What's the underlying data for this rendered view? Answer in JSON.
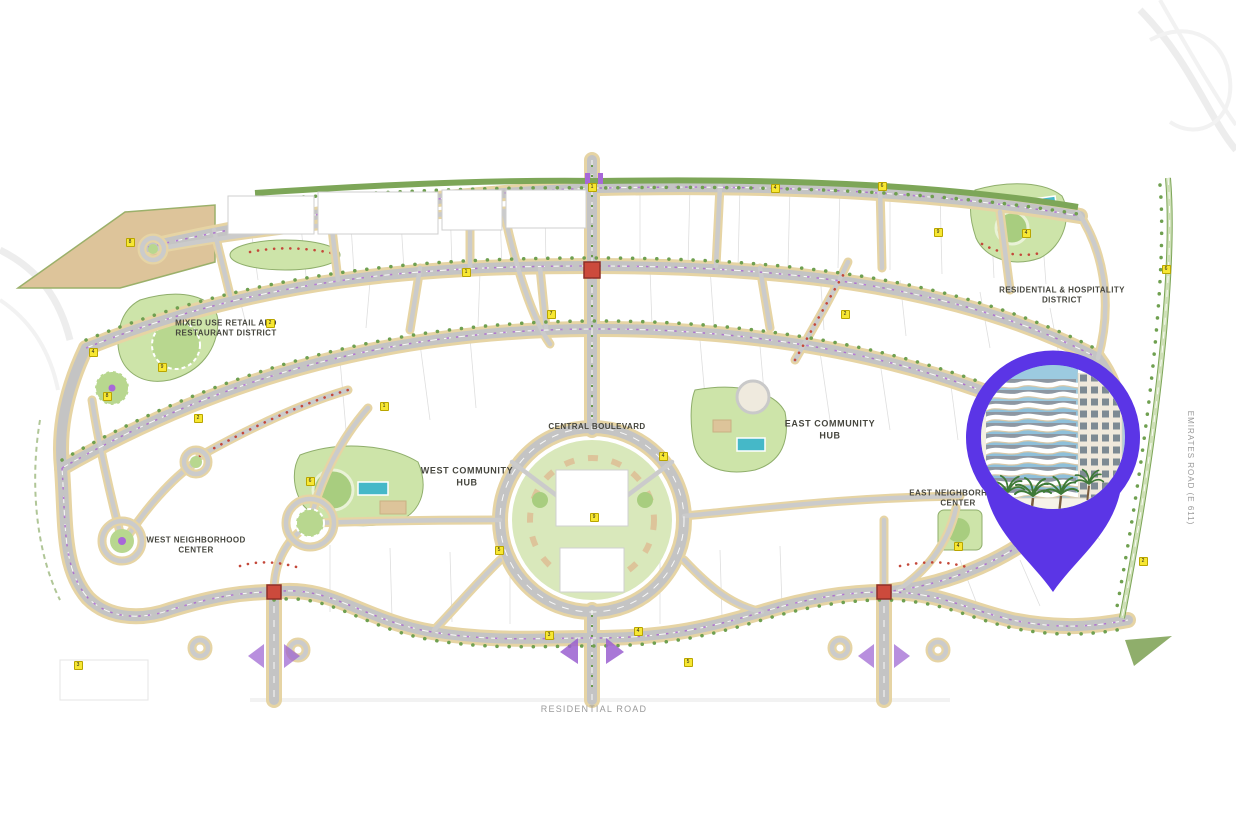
{
  "page": {
    "description": "Community master plan map with location pin highlighting a residential building"
  },
  "map": {
    "labels": {
      "mixed_use_district": "MIXED USE RETAIL AND\nRESTAURANT DISTRICT",
      "central_boulevard": "CENTRAL BOULEVARD",
      "west_community_hub": "WEST COMMUNITY\nHUB",
      "east_community_hub": "EAST COMMUNITY\nHUB",
      "west_neighborhood_center": "WEST NEIGHBORHOOD\nCENTER",
      "east_neighborhood_center": "EAST NEIGHBORHOOD\nCENTER",
      "residential_hospitality_district": "RESIDENTIAL & HOSPITALITY\nDISTRICT",
      "residential_road": "RESIDENTIAL ROAD",
      "emirates_road": "EMIRATES ROAD (E 611)"
    },
    "badges": [
      {
        "x": 130,
        "y": 242,
        "n": "8"
      },
      {
        "x": 466,
        "y": 272,
        "n": "1"
      },
      {
        "x": 592,
        "y": 187,
        "n": "1"
      },
      {
        "x": 775,
        "y": 188,
        "n": "4"
      },
      {
        "x": 882,
        "y": 186,
        "n": "6"
      },
      {
        "x": 938,
        "y": 232,
        "n": "9"
      },
      {
        "x": 1026,
        "y": 233,
        "n": "4"
      },
      {
        "x": 845,
        "y": 314,
        "n": "2"
      },
      {
        "x": 551,
        "y": 314,
        "n": "7"
      },
      {
        "x": 270,
        "y": 323,
        "n": "2"
      },
      {
        "x": 107,
        "y": 396,
        "n": "8"
      },
      {
        "x": 93,
        "y": 352,
        "n": "4"
      },
      {
        "x": 162,
        "y": 367,
        "n": "9"
      },
      {
        "x": 384,
        "y": 406,
        "n": "1"
      },
      {
        "x": 663,
        "y": 456,
        "n": "4"
      },
      {
        "x": 499,
        "y": 550,
        "n": "5"
      },
      {
        "x": 549,
        "y": 635,
        "n": "3"
      },
      {
        "x": 638,
        "y": 631,
        "n": "4"
      },
      {
        "x": 78,
        "y": 665,
        "n": "3"
      },
      {
        "x": 1166,
        "y": 269,
        "n": "6"
      },
      {
        "x": 1143,
        "y": 561,
        "n": "2"
      },
      {
        "x": 958,
        "y": 546,
        "n": "4"
      },
      {
        "x": 198,
        "y": 418,
        "n": "2"
      },
      {
        "x": 310,
        "y": 481,
        "n": "6"
      },
      {
        "x": 688,
        "y": 662,
        "n": "5"
      },
      {
        "x": 594,
        "y": 517,
        "n": "9"
      }
    ],
    "colors": {
      "road_gray": "#c4c4c4",
      "sand_shoulder": "#e6d4a4",
      "park_green": "#cde4a9",
      "tree_green": "#6fa050",
      "pool_teal": "#45b8c8",
      "intersection_red": "#cc4a3c",
      "median_purple": "#a85fd0"
    }
  },
  "pin": {
    "color": "#5b35e6",
    "image": "residential-building-photo",
    "sky_color": "#8fc0da"
  }
}
